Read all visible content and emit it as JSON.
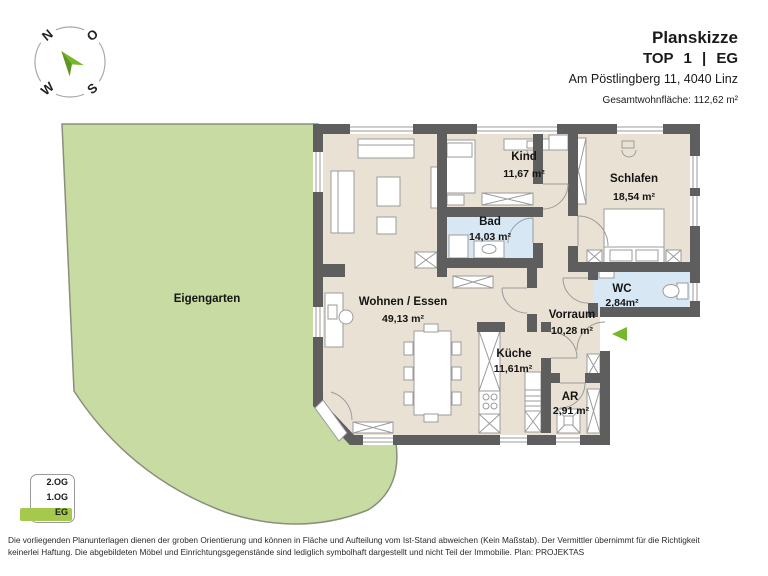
{
  "header": {
    "title": "Planskizze",
    "unit_line": "TOP 1 | EG",
    "address": "Am Pöstlingberg 11, 4040 Linz",
    "total_area_label": "Gesamtwohnfläche: 112,62 m²"
  },
  "compass": {
    "north": "N",
    "east": "O",
    "south": "S",
    "west": "W"
  },
  "plan": {
    "garden_label": "Eigengarten",
    "rooms": [
      {
        "id": "kind",
        "name": "Kind",
        "area": "11,67 m²"
      },
      {
        "id": "schlafen",
        "name": "Schlafen",
        "area": "18,54 m²"
      },
      {
        "id": "bad",
        "name": "Bad",
        "area": "14,03 m²"
      },
      {
        "id": "wohnen-essen",
        "name": "Wohnen / Essen",
        "area": "49,13 m²"
      },
      {
        "id": "wc",
        "name": "WC",
        "area": "2,84m²"
      },
      {
        "id": "vorraum",
        "name": "Vorraum",
        "area": "10,28 m²"
      },
      {
        "id": "kueche",
        "name": "Küche",
        "area": "11,61m²"
      },
      {
        "id": "ar",
        "name": "AR",
        "area": "2,91 m²"
      }
    ]
  },
  "floor_selector": {
    "floors": [
      {
        "label": "2.OG",
        "active": false
      },
      {
        "label": "1.OG",
        "active": false
      },
      {
        "label": "EG",
        "active": true
      }
    ]
  },
  "disclaimer": {
    "line1": "Die vorliegenden Planunterlagen dienen der groben Orientierung und können in Fläche und Aufteilung vom Ist-Stand abweichen (Kein Maßstab). Der Vermittler übernimmt für die Richtigkeit",
    "line2": "keinerlei Haftung. Die abgebildeten Möbel und Einrichtungsgegenstände sind lediglich symbolhaft dargestellt und nicht Teil der Immobilie. Plan: PROJEKTAS"
  },
  "colors": {
    "wall": "#5e5e5e",
    "floor": "#e9e1d4",
    "wet_room": "#d7e8f4",
    "garden": "#c8dba2",
    "garden_border": "#8a8f7c",
    "accent_green": "#76b82a",
    "floor_badge_green": "#a5c94c"
  }
}
